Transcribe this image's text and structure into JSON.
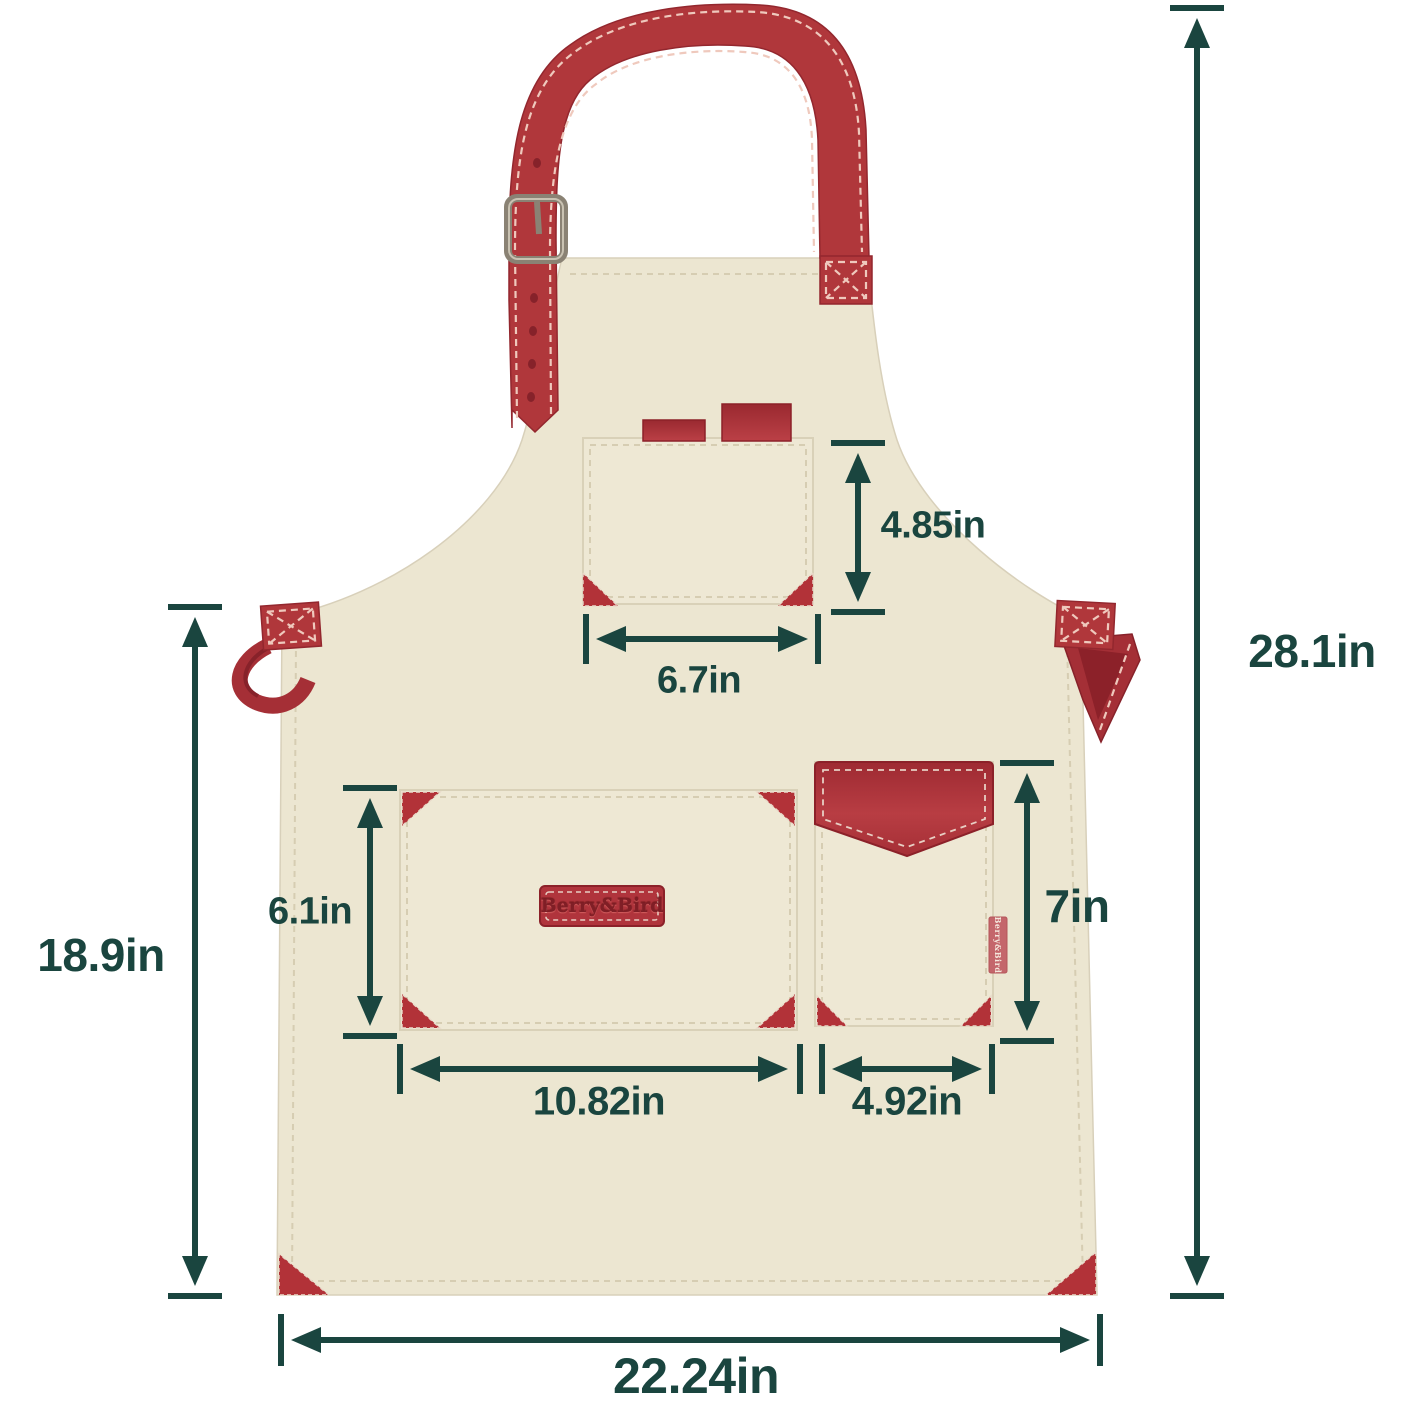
{
  "product": {
    "type": "bib apron with pockets",
    "brand_patch_text": "Berry&Bird",
    "side_tag_text": "Berry&Bird"
  },
  "measurements": {
    "overall_height": "28.1in",
    "body_height": "18.9in",
    "bottom_width": "22.24in",
    "chest_pocket_height": "4.85in",
    "chest_pocket_width": "6.7in",
    "front_pocket_height": "6.1in",
    "front_pocket_width": "10.82in",
    "side_pocket_height": "7in",
    "side_pocket_width": "4.92in"
  },
  "colors": {
    "dimension_annotation": "#1a453f",
    "apron_fabric": "#ece6d1",
    "leather_red": "#b0373b",
    "leather_red_dark": "#8f252d",
    "buckle_metal": "#8a8274",
    "background": "#ffffff"
  }
}
